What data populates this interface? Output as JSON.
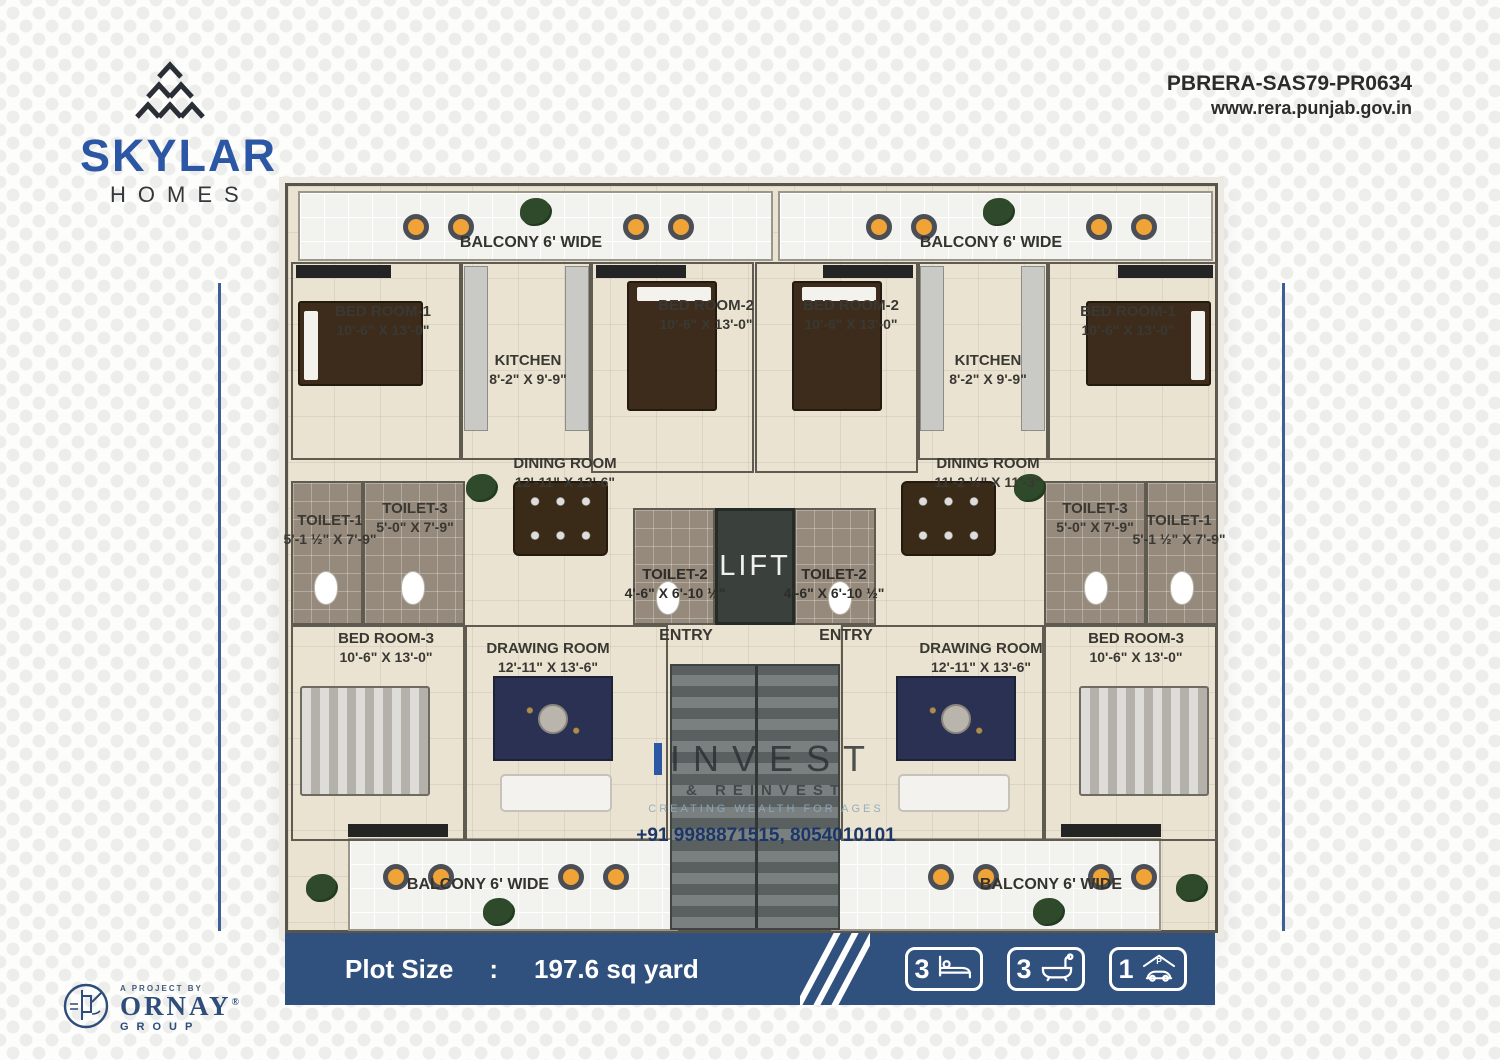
{
  "brand": {
    "name": "SKYLAR",
    "sub": "HOMES"
  },
  "rera": {
    "id": "PBRERA-SAS79-PR0634",
    "website": "www.rera.punjab.gov.in"
  },
  "floorplan": {
    "balconies": {
      "top_left": "BALCONY 6' WIDE",
      "top_right": "BALCONY 6' WIDE",
      "bottom_left": "BALCONY 6' WIDE",
      "bottom_right": "BALCONY 6' WIDE"
    },
    "lift": "LIFT",
    "entries": {
      "left": "ENTRY",
      "right": "ENTRY"
    },
    "left_unit": {
      "bedroom1": {
        "name": "BED ROOM-1",
        "size": "10'-6\" X 13'-0\""
      },
      "kitchen": {
        "name": "KITCHEN",
        "size": "8'-2\" X 9'-9\""
      },
      "bedroom2": {
        "name": "BED ROOM-2",
        "size": "10'-6\" X 13'-0\""
      },
      "dining": {
        "name": "DINING ROOM",
        "size": "12'-11\" X 13'-6\""
      },
      "toilet1": {
        "name": "TOILET-1",
        "size": "5'-1 ½\" X 7'-9\""
      },
      "toilet3": {
        "name": "TOILET-3",
        "size": "5'-0\" X 7'-9\""
      },
      "toilet2": {
        "name": "TOILET-2",
        "size": "4'-6\" X 6'-10 ½\""
      },
      "bedroom3": {
        "name": "BED ROOM-3",
        "size": "10'-6\" X 13'-0\""
      },
      "drawing": {
        "name": "DRAWING ROOM",
        "size": "12'-11\" X 13'-6\""
      }
    },
    "right_unit": {
      "bedroom2": {
        "name": "BED ROOM-2",
        "size": "10'-6\" X 13'-0\""
      },
      "kitchen": {
        "name": "KITCHEN",
        "size": "8'-2\" X 9'-9\""
      },
      "bedroom1": {
        "name": "BED ROOM-1",
        "size": "10'-6\" X 13'-0\""
      },
      "dining": {
        "name": "DINING ROOM",
        "size": "11'-2 ½\" X 11'-3\""
      },
      "toilet3": {
        "name": "TOILET-3",
        "size": "5'-0\" X 7'-9\""
      },
      "toilet1": {
        "name": "TOILET-1",
        "size": "5'-1 ½\" X 7'-9\""
      },
      "toilet2": {
        "name": "TOILET-2",
        "size": "4'-6\" X 6'-10 ½\""
      },
      "drawing": {
        "name": "DRAWING ROOM",
        "size": "12'-11\" X 13'-6\""
      },
      "bedroom3": {
        "name": "BED ROOM-3",
        "size": "10'-6\" X 13'-0\""
      }
    },
    "watermark": {
      "line1": "INVEST",
      "line2": "& REINVEST",
      "line3": "CREATING WEALTH FOR AGES",
      "phone": "+91 9988871515, 8054010101"
    }
  },
  "footer": {
    "plot_size_label": "Plot Size",
    "separator": ":",
    "plot_size_value": "197.6 sq yard",
    "badges": [
      {
        "count": "3",
        "icon": "bed-icon"
      },
      {
        "count": "3",
        "icon": "bath-icon"
      },
      {
        "count": "1",
        "icon": "parking-icon"
      }
    ]
  },
  "project": {
    "tagline": "A PROJECT BY",
    "name": "ORNAY",
    "registered": "®",
    "group": "GROUP"
  },
  "colors": {
    "brand_blue": "#2b57a5",
    "navy_bar": "#30507d",
    "floor_cream": "#ebe3d2",
    "text_dark": "#2b2b2b"
  }
}
